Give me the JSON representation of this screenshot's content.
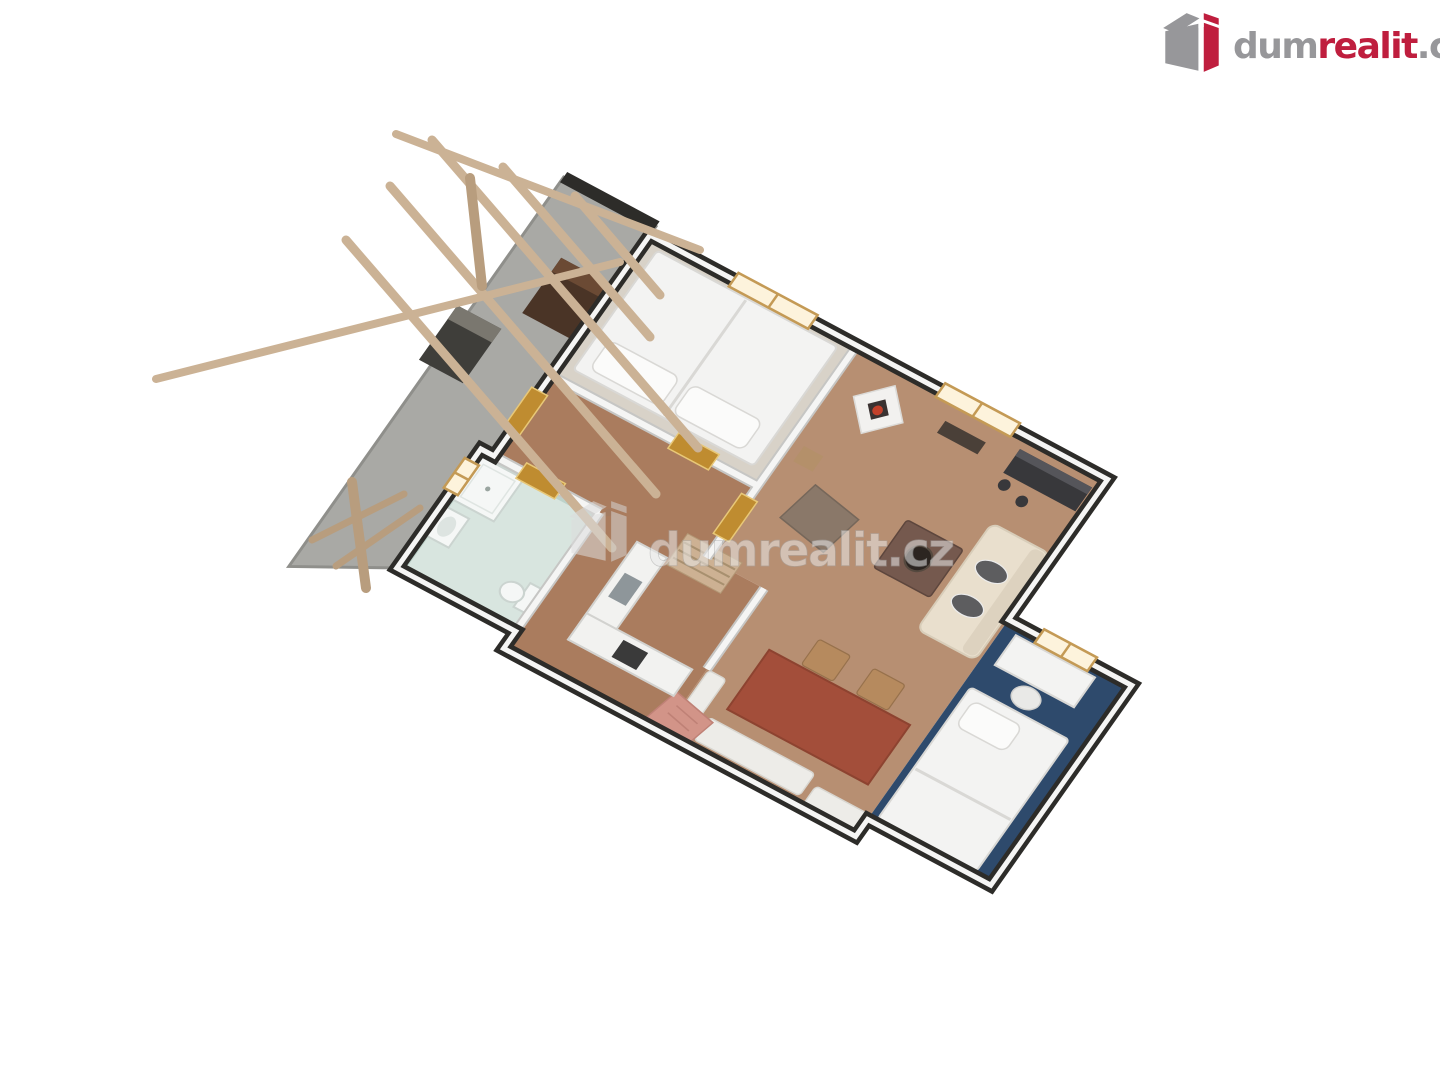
{
  "page": {
    "background": "#ffffff"
  },
  "brand": {
    "part1": "dum",
    "part2": "realit",
    "part3": ".cz",
    "icon": "building-icon"
  },
  "watermark": {
    "text": "dumrealit.cz",
    "icon": "building-icon",
    "opacity": 0.55
  },
  "floorplan": {
    "type": "3d-floor-plan",
    "rooms": [
      {
        "name": "terrace"
      },
      {
        "name": "bedroom"
      },
      {
        "name": "living-room"
      },
      {
        "name": "dining-area"
      },
      {
        "name": "hallway"
      },
      {
        "name": "kitchen"
      },
      {
        "name": "bathroom"
      },
      {
        "name": "kids-bedroom"
      }
    ],
    "features": [
      "pergola",
      "grill",
      "storage-bench",
      "double-bed",
      "fireplace",
      "wall-shelf",
      "tv-sideboard",
      "sofa",
      "armchair",
      "coffee-table",
      "dining-table",
      "dining-chairs",
      "benches",
      "rug",
      "kitchen-counter",
      "sink",
      "oven",
      "stairs-bench",
      "shower",
      "washbasin",
      "toilet",
      "desk",
      "desk-chair",
      "single-bed",
      "windows",
      "doors"
    ]
  },
  "colors": {
    "logo_red": "#bf1e3e",
    "logo_gray": "#97979a",
    "wall_dark": "#2d2c29",
    "wall_white": "#f5f5f4",
    "wall_edge": "#c6c6c4",
    "terrace_floor": "#a9a9a5",
    "bedroom_floor": "#d8d2c8",
    "living_floor": "#b78f72",
    "hall_floor": "#aa7c5e",
    "bath_floor": "#d8e5df",
    "bath_tile": "#b9cfc7",
    "kids_floor": "#2e4a6c",
    "beam_wood": "#cbb295",
    "beam_dark": "#b89d7e",
    "door_amber": "#bf8c30",
    "door_frame": "#e8c878",
    "window_frame": "#c49a55",
    "window_glow": "#fdf3dc",
    "bed_white": "#f3f3f2",
    "bed_line": "#d9d8d5",
    "pillow_white": "#fbfbfa",
    "sofa_cream": "#e9dfcd",
    "cushion_dark": "#5d5d5f",
    "sideboard_dark": "#38383b",
    "coffee_table": "#75594e",
    "bowl_dark": "#2c2521",
    "armchair": "#8a7869",
    "stool_wood": "#b4906a",
    "dining_table": "#a34e3a",
    "table_edge": "#8d4330",
    "chair_wood": "#b68a5e",
    "bench_white": "#edece8",
    "rug_pink": "#d29488",
    "rug_line": "#bf8176",
    "counter_white": "#f2f2f0",
    "counter_edge": "#d2d2cf",
    "sink_gray": "#8e969a",
    "oven_dark": "#3a3a3a",
    "steps_wood": "#cdb193",
    "steps_line": "#a8906f",
    "fixture_white": "#f5f7f6",
    "fixture_edge": "#cbd4d0",
    "basin": "#dde4e1",
    "grill_body": "#3f3e3a",
    "grill_top": "#7a776f",
    "bench_brown": "#4a3426",
    "bench_brown_top": "#6b4a34"
  }
}
